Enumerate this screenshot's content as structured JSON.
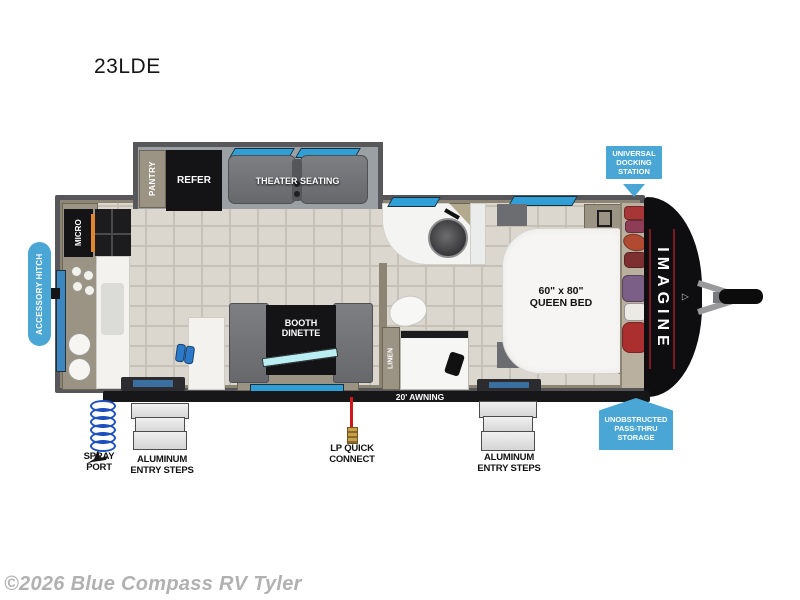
{
  "title": "23LDE",
  "watermark": "©2026 Blue Compass RV Tyler",
  "plan": {
    "pantry": "PANTRY",
    "refer": "REFER",
    "theater": "THEATER SEATING",
    "micro": "MICRO",
    "dinette_l1": "BOOTH",
    "dinette_l2": "DINETTE",
    "linen": "LINEN",
    "bed_l1": "60\" x 80\"",
    "bed_l2": "QUEEN BED",
    "brand": "IMAGINE",
    "awning": "20' AWNING"
  },
  "callouts": {
    "docking": [
      "UNIVERSAL",
      "DOCKING",
      "STATION"
    ],
    "accessory_hitch": "ACCESSORY HITCH",
    "passthru": [
      "UNOBSTRUCTED",
      "PASS-THRU",
      "STORAGE"
    ]
  },
  "labels": {
    "spray": [
      "SPRAY",
      "PORT"
    ],
    "steps_left": [
      "ALUMINUM",
      "ENTRY STEPS"
    ],
    "lp": [
      "LP QUICK",
      "CONNECT"
    ],
    "steps_right": [
      "ALUMINUM",
      "ENTRY STEPS"
    ]
  },
  "colors": {
    "callout_blue": "#49a6d5",
    "wall_gray": "#55555a",
    "trim_tan": "#8d8573",
    "floor_tile": "#dcd7ce",
    "window_blue": "#2f9fd6",
    "awning_black": "#17171a",
    "accent_red": "#7a1a22"
  }
}
